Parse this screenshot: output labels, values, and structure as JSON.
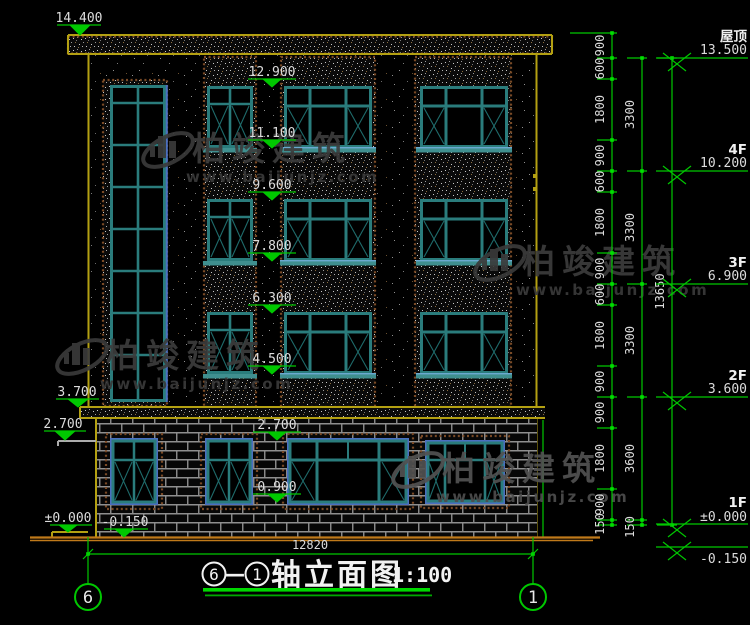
{
  "drawing": {
    "type": "architectural-elevation",
    "background": "#000000"
  },
  "title": {
    "axis_left": "6",
    "sep": "—",
    "axis_right": "1",
    "text": "轴立面图",
    "scale": "1:100"
  },
  "grid": {
    "left_bubble": "6",
    "right_bubble": "1"
  },
  "watermark": {
    "brand": "柏竣建筑",
    "url": "www.baijunjz.com"
  },
  "levels_left": {
    "parapet": "14.400",
    "slab": "3.700",
    "ledge": "2.700",
    "zero": "±0.000",
    "grade": "-0.150"
  },
  "levels_mid": {
    "l0": "12.900",
    "l1": "11.100",
    "l2": "9.600",
    "l3": "7.800",
    "l4": "6.300",
    "l5": "4.500",
    "l6": "2.700",
    "l7": "0.900"
  },
  "levels_right": {
    "r0": {
      "name": "屋顶",
      "value": "13.500"
    },
    "r1": {
      "name": "4F",
      "value": "10.200"
    },
    "r2": {
      "name": "3F",
      "value": "6.900"
    },
    "r3": {
      "name": "2F",
      "value": "3.600"
    },
    "r4": {
      "name": "1F",
      "value": "±0.000"
    },
    "r5": {
      "value": "-0.150"
    }
  },
  "dims": {
    "chain": [
      "900",
      "600",
      "1800",
      "900",
      "600",
      "1800",
      "900",
      "600",
      "1800",
      "900",
      "900",
      "1800",
      "900",
      "150"
    ],
    "floors": [
      "3300",
      "3300",
      "3300",
      "3600",
      "150"
    ],
    "total_height": "13650",
    "total_width": "12820"
  },
  "colors": {
    "dim_green": "#00c800",
    "line_yellow": "#b3a012",
    "ground_orange": "#c07a1a",
    "window_teal": "#2a7c7c",
    "window_blue": "#4a6fc0",
    "mortar_gray": "#8f8f8f",
    "text_white": "#dcdcdc",
    "watermark_gray": "#3c3c3c"
  }
}
